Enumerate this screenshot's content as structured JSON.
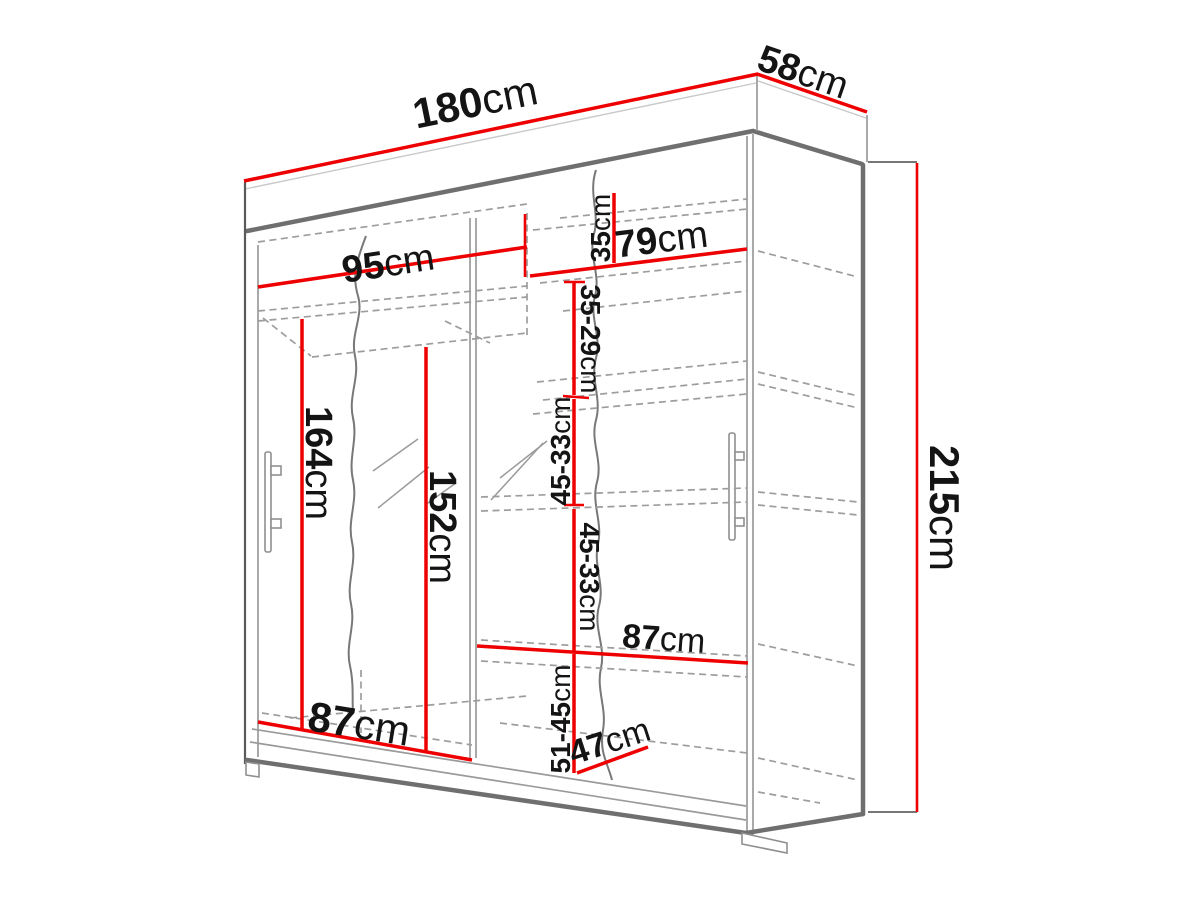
{
  "diagram": {
    "type": "wardrobe-technical-drawing",
    "unit": "cm",
    "colors": {
      "dimension_line": "#ee0000",
      "label_text": "#141414",
      "cabinet_line": "#8f8f8f"
    },
    "dimensions": {
      "total_width": "180cm",
      "total_depth": "58cm",
      "total_height": "215cm",
      "left_section_width": "95cm",
      "right_section_width": "79cm",
      "right_top_shelf_height": "35cm",
      "right_upper_shelf_height": "35-29cm",
      "right_middle_shelf_height_1": "45-33cm",
      "right_middle_shelf_height_2": "45-33cm",
      "right_lower_shelf_height": "51-45cm",
      "left_hanging_height": "164cm",
      "left_inner_height": "152cm",
      "left_bottom_width": "87cm",
      "right_shelf_width": "87cm",
      "right_bottom_width": "47cm"
    }
  }
}
